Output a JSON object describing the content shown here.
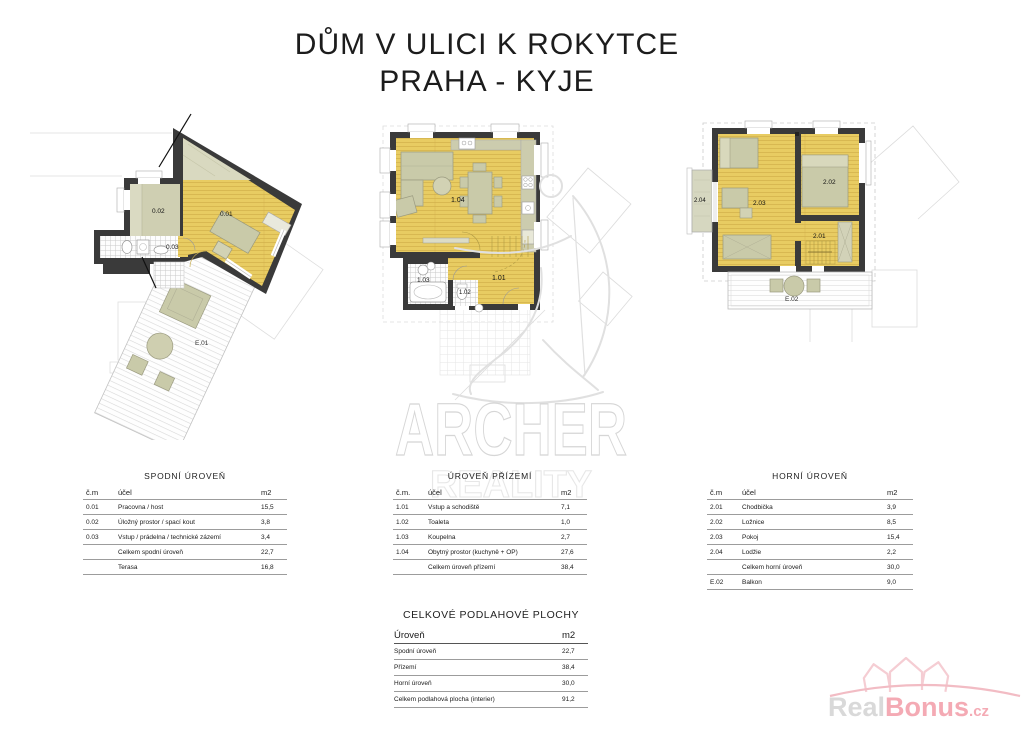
{
  "title": {
    "line1": "DŮM V ULICI K ROKYTCE",
    "line2": "PRAHA - KYJE"
  },
  "watermark": {
    "line1": "ARCHER",
    "line2": "REALITY"
  },
  "plans": {
    "lower": {
      "labels": {
        "r01": "0.01",
        "r02": "0.02",
        "r03": "0.03",
        "terrace": "E.01"
      }
    },
    "ground": {
      "labels": {
        "r101": "1.01",
        "r102": "1.02",
        "r103": "1.03",
        "r104": "1.04"
      }
    },
    "upper": {
      "labels": {
        "r201": "2.01",
        "r202": "2.02",
        "r203": "2.03",
        "r204": "2.04",
        "balcony": "E.02"
      }
    }
  },
  "tables": {
    "lower": {
      "title": "SPODNÍ ÚROVEŇ",
      "headers": [
        "č.m",
        "účel",
        "m2"
      ],
      "rows": [
        [
          "0.01",
          "Pracovna / host",
          "15,5"
        ],
        [
          "0.02",
          "Úložný prostor / spací kout",
          "3,8"
        ],
        [
          "0.03",
          "Vstup / prádelna / technické zázemí",
          "3,4"
        ],
        [
          "",
          "Celkem spodní úroveň",
          "22,7"
        ],
        [
          "",
          "Terasa",
          "16,8"
        ]
      ]
    },
    "ground": {
      "title": "ÚROVEŇ PŘÍZEMÍ",
      "headers": [
        "č.m.",
        "účel",
        "m2"
      ],
      "rows": [
        [
          "1.01",
          "Vstup a schodiště",
          "7,1"
        ],
        [
          "1.02",
          "Toaleta",
          "1,0"
        ],
        [
          "1.03",
          "Koupelna",
          "2,7"
        ],
        [
          "1.04",
          "Obytný prostor (kuchyně + OP)",
          "27,6"
        ],
        [
          "",
          "Celkem úroveň přízemí",
          "38,4"
        ]
      ]
    },
    "upper": {
      "title": "HORNÍ ÚROVEŇ",
      "headers": [
        "č.m",
        "účel",
        "m2"
      ],
      "rows": [
        [
          "2.01",
          "Chodbička",
          "3,9"
        ],
        [
          "2.02",
          "Ložnice",
          "8,5"
        ],
        [
          "2.03",
          "Pokoj",
          "15,4"
        ],
        [
          "2.04",
          "Lodžie",
          "2,2"
        ],
        [
          "",
          "Celkem horní úroveň",
          "30,0"
        ],
        [
          "E.02",
          "Balkon",
          "9,0"
        ]
      ]
    },
    "total": {
      "title": "CELKOVÉ PODLAHOVÉ PLOCHY",
      "headers": [
        "Úroveň",
        "m2"
      ],
      "rows": [
        [
          "Spodní úroveň",
          "22,7"
        ],
        [
          "Přízemí",
          "38,4"
        ],
        [
          "Horní úroveň",
          "30,0"
        ],
        [
          "Celkem podlahová plocha (interier)",
          "91,2"
        ]
      ]
    }
  },
  "logo": {
    "part1": "Real",
    "part2": "Bonus",
    "part3": ".cz"
  },
  "colors": {
    "wall": "#3a3a3a",
    "floor_yellow": "#e8cc62",
    "plank_line": "#d2b14b",
    "furniture_olive": "#c9caa9",
    "pale_olive": "#d9d9c0",
    "logo_pink": "#f4aab4",
    "logo_gray": "#d9d9d9",
    "watermark_gray": "#d6d6d6"
  }
}
